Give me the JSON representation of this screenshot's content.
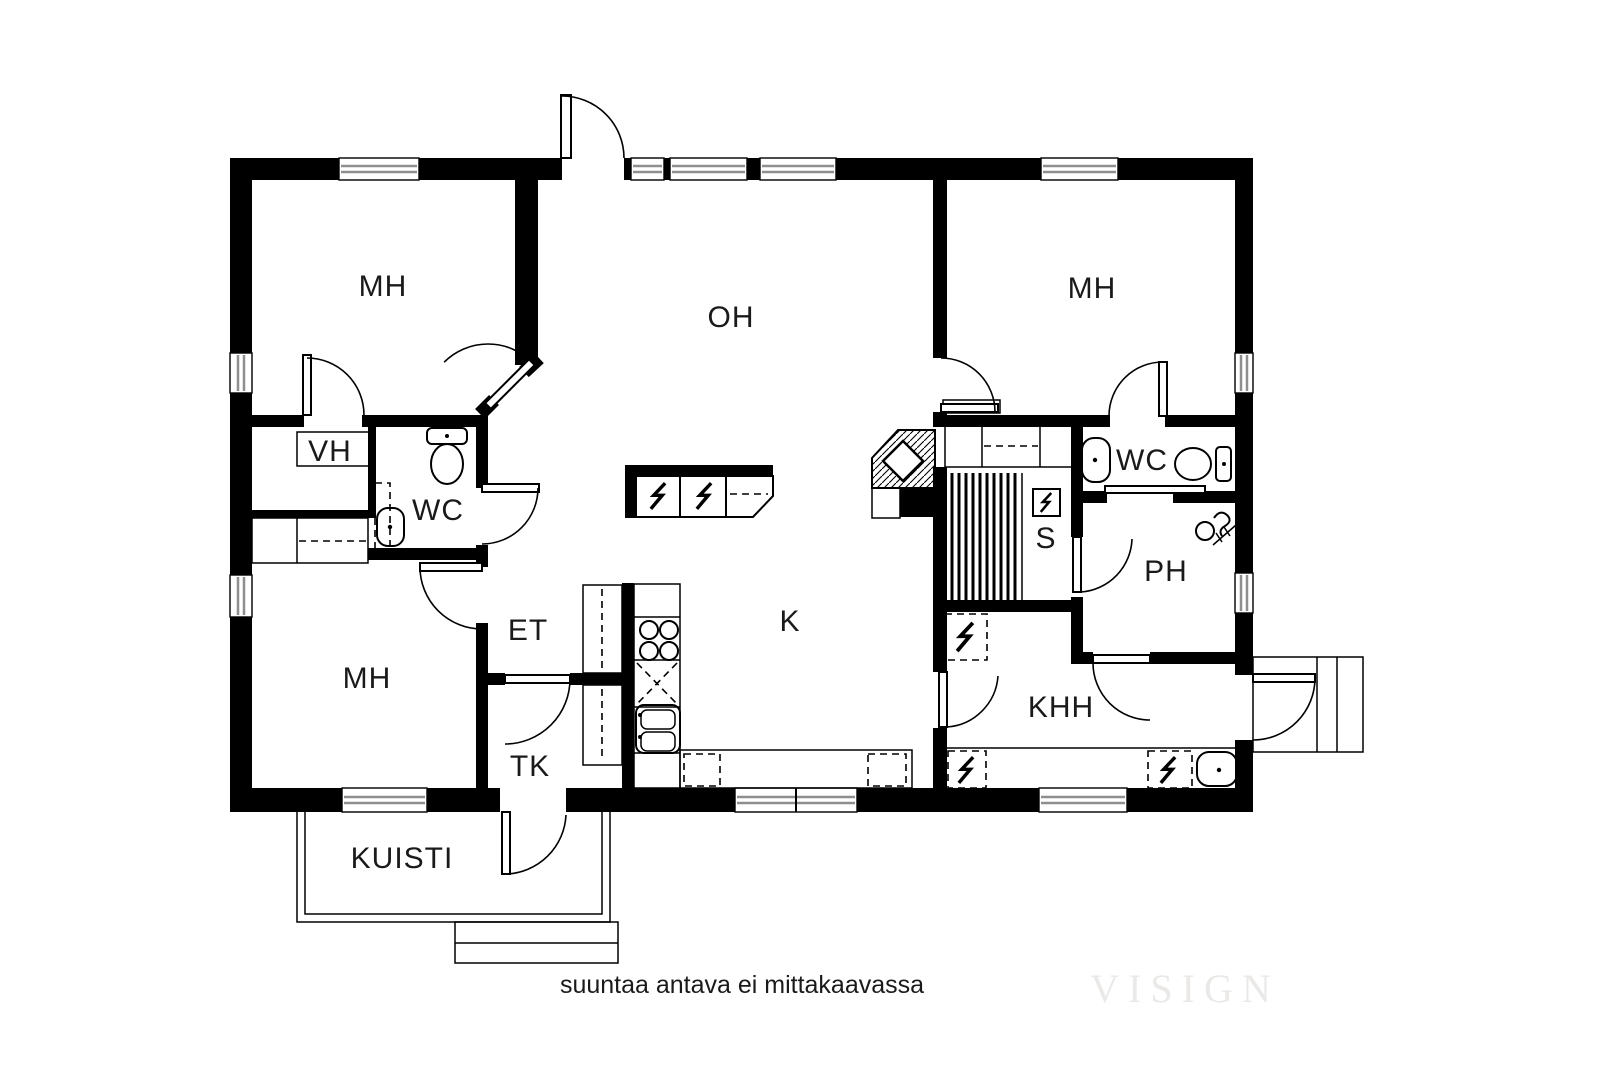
{
  "plan": {
    "rooms": [
      {
        "id": "mh-top-left",
        "label": "MH"
      },
      {
        "id": "oh",
        "label": "OH"
      },
      {
        "id": "mh-right",
        "label": "MH"
      },
      {
        "id": "vh",
        "label": "VH"
      },
      {
        "id": "wc-left",
        "label": "WC"
      },
      {
        "id": "et",
        "label": "ET"
      },
      {
        "id": "mh-bottom-left",
        "label": "MH"
      },
      {
        "id": "tk",
        "label": "TK"
      },
      {
        "id": "k",
        "label": "K"
      },
      {
        "id": "s",
        "label": "S"
      },
      {
        "id": "wc-right",
        "label": "WC"
      },
      {
        "id": "ph",
        "label": "PH"
      },
      {
        "id": "khh",
        "label": "KHH"
      },
      {
        "id": "kuisti",
        "label": "KUISTI"
      }
    ],
    "icons": [
      "toilet-icon",
      "sink-icon",
      "shower-icon",
      "stove-icon",
      "kitchen-sink-icon",
      "appliance-reservation-icon",
      "sauna-stove-icon",
      "sauna-benches",
      "fireplace",
      "wardrobe",
      "door",
      "window"
    ],
    "colors": {
      "wall": "#000000",
      "background": "#ffffff",
      "window_band": "#8f8f8f",
      "watermark": "#ebe9e7"
    }
  },
  "footer": {
    "note": "suuntaa antava ei mittakaavassa",
    "watermark": "VISIGN"
  }
}
